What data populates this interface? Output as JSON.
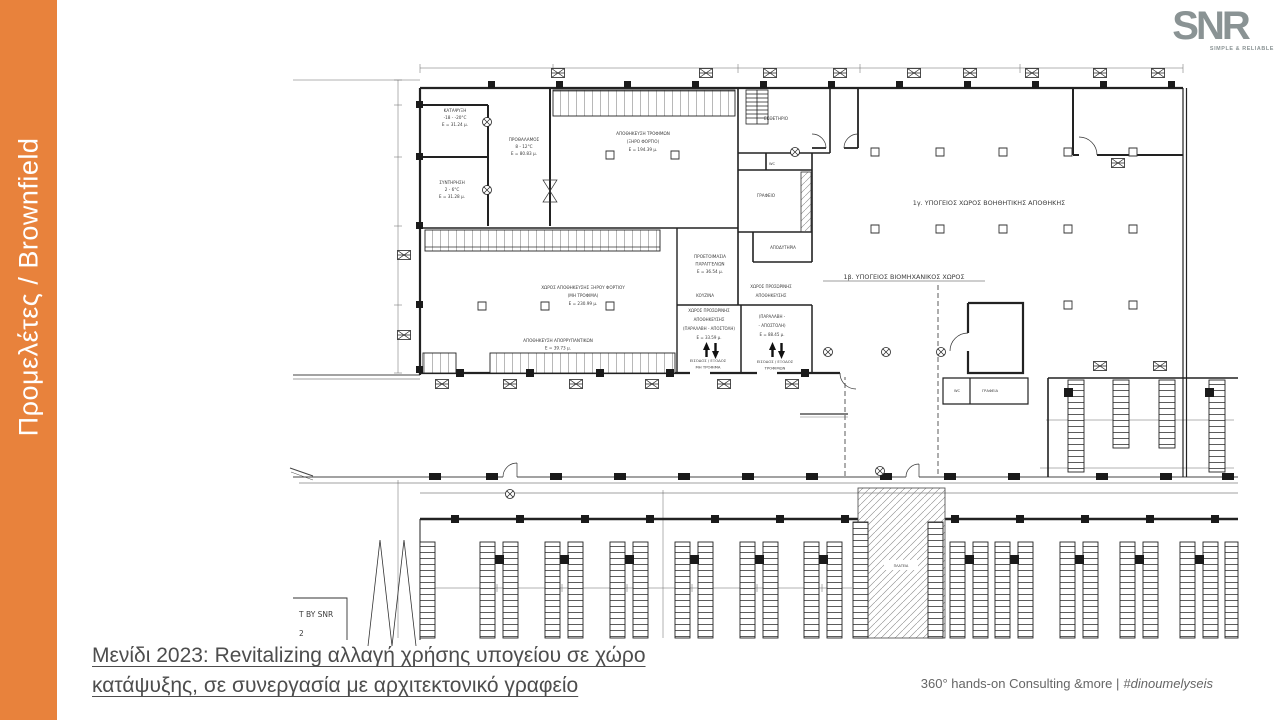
{
  "slide": {
    "sidebar": {
      "label": "Προμελέτες / Brownfield",
      "color": "#E8823C"
    },
    "logo": {
      "text": "SNR",
      "tagline": "SIMPLE & RELIABLE",
      "color": "#8A9394"
    },
    "caption": {
      "line1": "Μενίδι 2023: Revitalizing αλλαγή χρήσης υπογείου σε χώρο",
      "line2": "κατάψυξης, σε συνεργασία με αρχιτεκτονικό γραφείο"
    },
    "footer": {
      "text": "360° hands-on Consulting &more |",
      "hashtag": "#dinoumelyseis"
    }
  },
  "plan": {
    "ink": "#3c3c3c",
    "labels": [
      {
        "id": "katapsixi",
        "x": 455,
        "y": 112,
        "s": 4.2,
        "lh": 7,
        "lines": [
          "ΚΑΤΑΨΥΞΗ",
          "-18 - -20°C",
          "Ε = 31.24 μ."
        ]
      },
      {
        "id": "sintirisi",
        "x": 452,
        "y": 184,
        "s": 4.2,
        "lh": 7,
        "lines": [
          "ΣΥΝΤΗΡΗΣΗ",
          "2 - 6°C",
          "Ε = 31.28 μ."
        ]
      },
      {
        "id": "prothalamos",
        "x": 524,
        "y": 141,
        "s": 4.2,
        "lh": 7,
        "lines": [
          "ΠΡΟΘΑΛΑΜΟΣ",
          "8 - 12°C",
          "Ε = 80.83 μ."
        ]
      },
      {
        "id": "apothikefsi-trofimon",
        "x": 643,
        "y": 135,
        "s": 4.2,
        "lh": 8,
        "lines": [
          "ΑΠΟΘΗΚΕΥΣΗ ΤΡΟΦΙΜΩΝ",
          "(ΞΗΡΟ ΦΟΡΤΙΟ)",
          "Ε = 194.39 μ."
        ]
      },
      {
        "id": "ektheterio",
        "x": 776,
        "y": 120,
        "s": 4.2,
        "lines": [
          "ΕΚΘΕΤΗΡΙΟ"
        ]
      },
      {
        "id": "wc-upper",
        "x": 772,
        "y": 165,
        "s": 3.6,
        "lines": [
          "WC"
        ]
      },
      {
        "id": "grafeio",
        "x": 766,
        "y": 197,
        "s": 4.2,
        "lines": [
          "ΓΡΑΦΕΙΟ"
        ]
      },
      {
        "id": "apodytiria",
        "x": 783,
        "y": 249,
        "s": 4,
        "lines": [
          "ΑΠΟΔΥΤΗΡΙΑ"
        ]
      },
      {
        "id": "zone-1g",
        "x": 989,
        "y": 205,
        "s": 6.4,
        "lines": [
          "1γ. ΥΠΟΓΕΙΟΣ ΧΩΡΟΣ ΒΟΗΘΗΤΙΚΗΣ ΑΠΟΘΗΚΗΣ"
        ]
      },
      {
        "id": "zone-1b",
        "x": 904,
        "y": 279,
        "s": 6.4,
        "u": 162,
        "lines": [
          "1β. ΥΠΟΓΕΙΟΣ ΒΙΟΜΗΧΑΝΙΚΟΣ ΧΩΡΟΣ"
        ]
      },
      {
        "id": "proetoimasia",
        "x": 710,
        "y": 258,
        "s": 4.2,
        "lh": 7.5,
        "lines": [
          "ΠΡΟΕΤΟΙΜΑΣΙΑ",
          "ΠΑΡΑΓΓΕΛΙΩΝ",
          "Ε = 36.54 μ."
        ]
      },
      {
        "id": "kouzina",
        "x": 705,
        "y": 297,
        "s": 4,
        "lines": [
          "ΚΟΥΖΙΝΑ"
        ]
      },
      {
        "id": "xoros-prosorinis-b",
        "x": 771,
        "y": 288,
        "s": 4,
        "lh": 9,
        "lines": [
          "ΧΩΡΟΣ ΠΡΟΣΩΡΙΝΗΣ",
          "ΑΠΟΘΗΚΕΥΣΗΣ"
        ]
      },
      {
        "id": "xoros-prosorinis-a",
        "x": 709,
        "y": 312,
        "s": 4,
        "lh": 9,
        "lines": [
          "ΧΩΡΟΣ ΠΡΟΣΩΡΙΝΗΣ",
          "ΑΠΟΘΗΚΕΥΣΗΣ",
          "(ΠΑΡΑΛΑΒΗ - ΑΠΟΣΤΟΛΗ)",
          "Ε = 33.59 μ."
        ]
      },
      {
        "id": "paralavi-apostoli-b",
        "x": 772,
        "y": 318,
        "s": 4,
        "lh": 9,
        "lines": [
          "(ΠΑΡΑΛΑΒΗ -",
          "- ΑΠΟΣΤΟΛΗ)",
          "Ε = 88.45 μ."
        ]
      },
      {
        "id": "eisodos-mi-trofima",
        "x": 708,
        "y": 362,
        "s": 3.8,
        "lh": 6.5,
        "lines": [
          "ΕΙΣΟΔΟΣ / ΕΞΟΔΟΣ",
          "ΜΗ ΤΡΟΦΙΜΑ"
        ]
      },
      {
        "id": "eisodos-trofimon",
        "x": 775,
        "y": 363,
        "s": 3.8,
        "lh": 6.5,
        "lines": [
          "ΕΙΣΟΔΟΣ / ΕΞΟΔΟΣ",
          "ΤΡΟΦΙΜΩΝ"
        ]
      },
      {
        "id": "xiro-fortio",
        "x": 583,
        "y": 289,
        "s": 4.2,
        "lh": 8,
        "lines": [
          "ΧΩΡΟΣ ΑΠΟΘΗΚΕΥΣΗΣ ΞΗΡΟΥ ΦΟΡΤΙΟΥ",
          "(ΜΗ ΤΡΟΦΙΜΑ)",
          "Ε = 230.99 μ."
        ]
      },
      {
        "id": "aporripantika",
        "x": 558,
        "y": 342,
        "s": 4.2,
        "lh": 7.5,
        "lines": [
          "ΑΠΟΘΗΚΕΥΣΗ ΑΠΟΡΡΥΠΑΝΤΙΚΩΝ",
          "Ε = 39.73 μ."
        ]
      },
      {
        "id": "wc-lower",
        "x": 957,
        "y": 392,
        "s": 3.6,
        "lines": [
          "WC"
        ]
      },
      {
        "id": "grafeia",
        "x": 990,
        "y": 392,
        "s": 3.8,
        "lines": [
          "ΓΡΑΦΕΙΑ"
        ]
      },
      {
        "id": "plateia",
        "x": 901,
        "y": 567,
        "s": 3.4,
        "lines": [
          "ΠΛΑΤΕΙΑ"
        ]
      },
      {
        "id": "stamp-by-snr",
        "x": 299,
        "y": 617,
        "s": 7.5,
        "lh": 19,
        "a": "start",
        "lines": [
          "T BY SNR",
          "2"
        ]
      }
    ]
  }
}
